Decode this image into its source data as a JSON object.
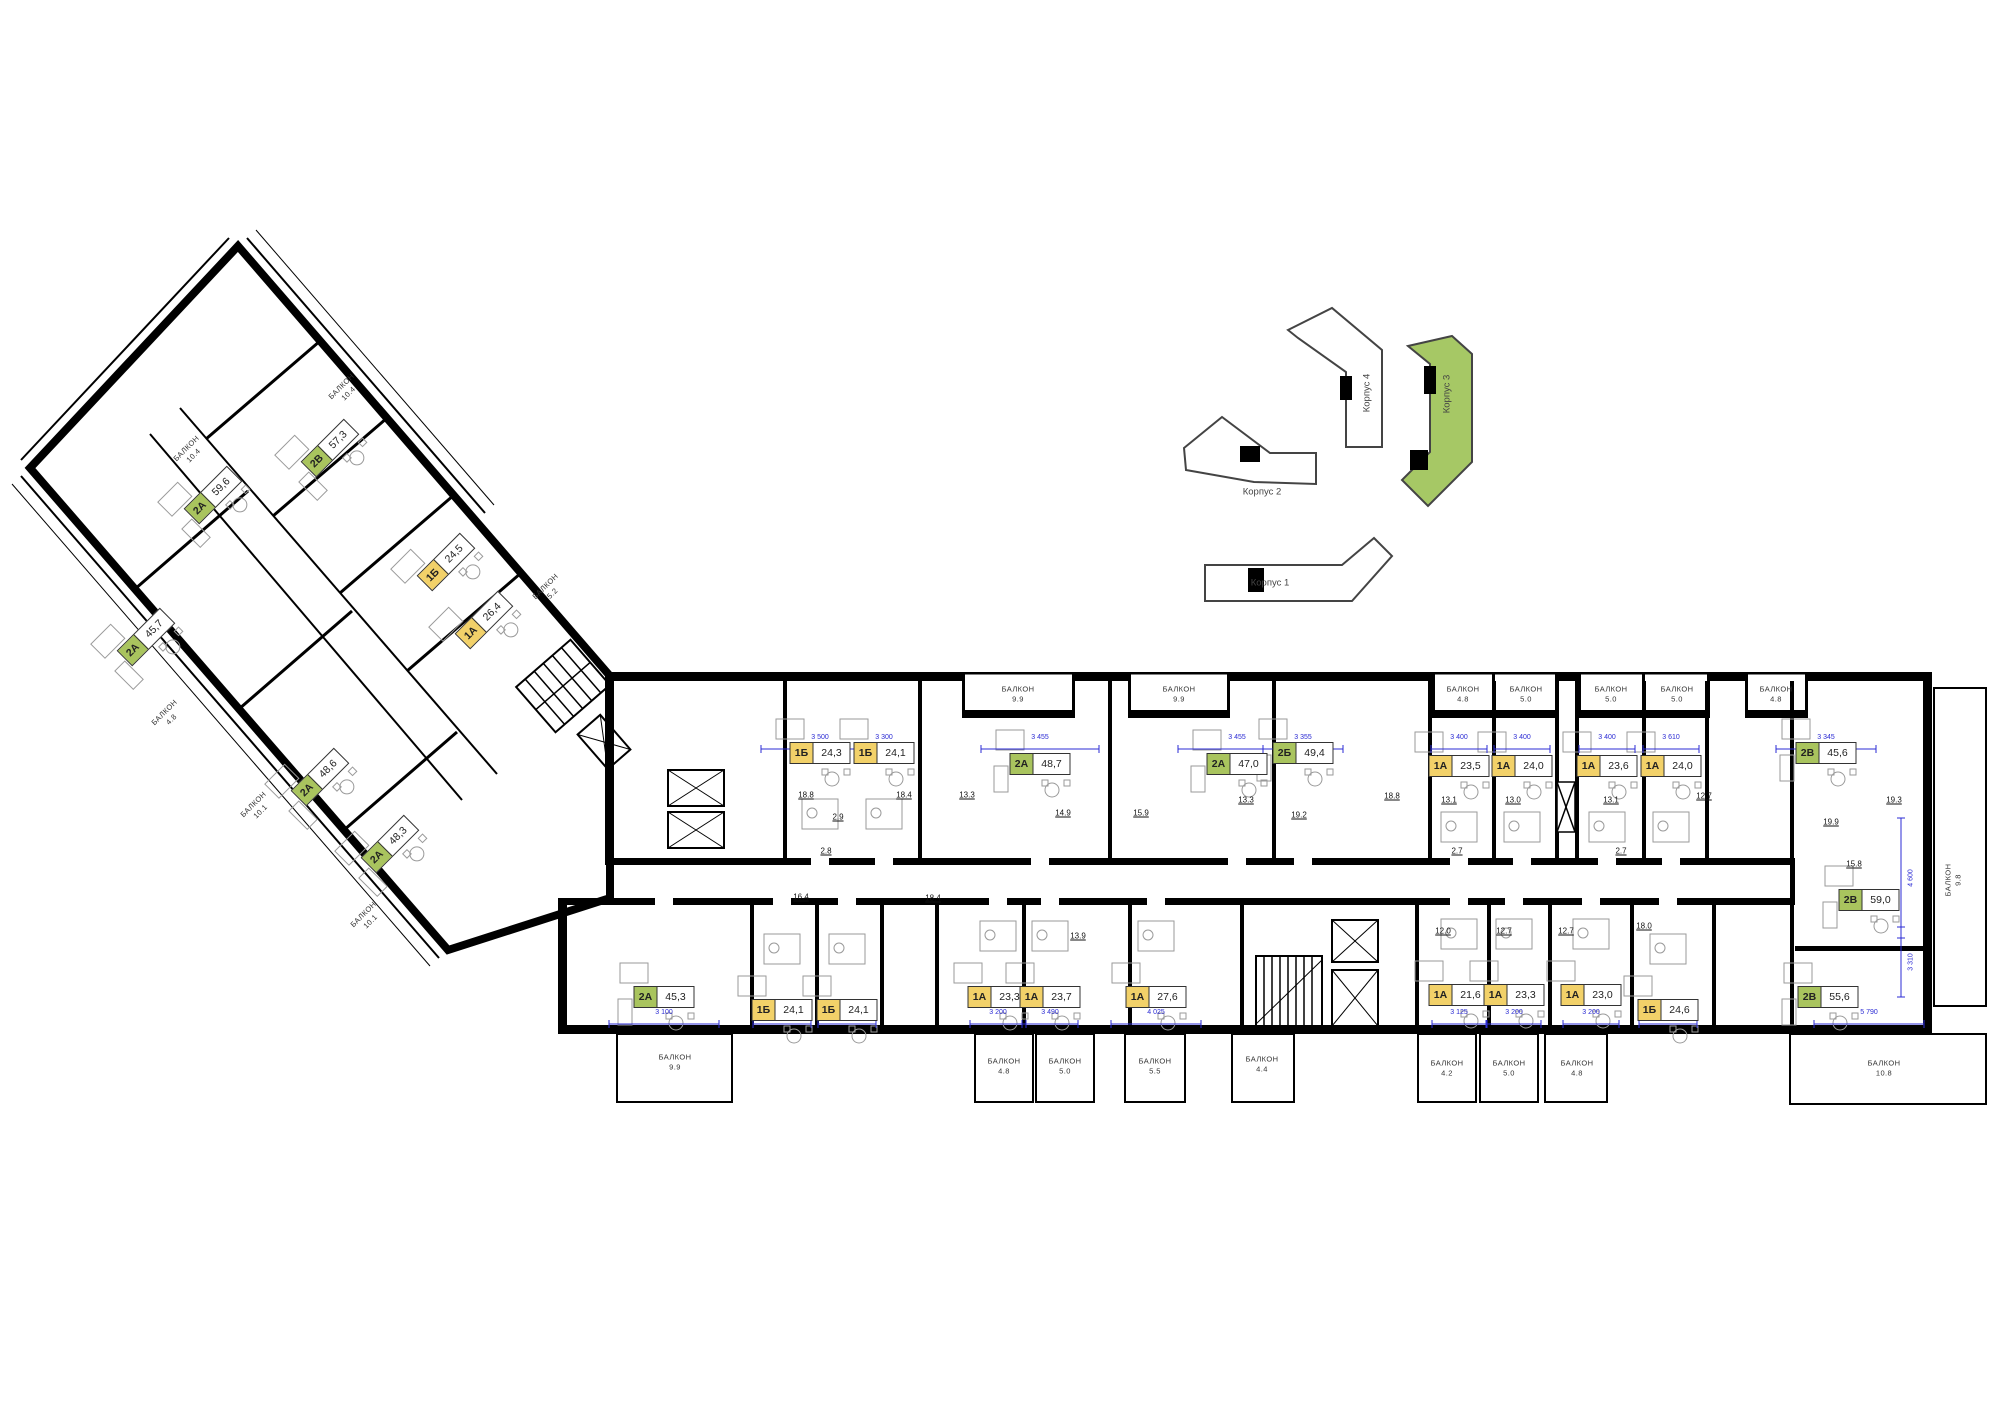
{
  "page_background": "#ffffff",
  "balcony_word": "БАЛКОН",
  "palette": {
    "one_room_badge": "#f2d169",
    "two_room_badge": "#a9c45e",
    "minimap_highlight": "#a6c865",
    "wall": "#000000",
    "dimension_blue": "#2b2bd4"
  },
  "minimap": {
    "corpuses": [
      {
        "label": "Корпус 1",
        "highlighted": false
      },
      {
        "label": "Корпус 2",
        "highlighted": false
      },
      {
        "label": "Корпус 3",
        "highlighted": true
      },
      {
        "label": "Корпус 4",
        "highlighted": false
      }
    ]
  },
  "units": [
    {
      "type": "2В",
      "area": "57,3",
      "color": "green",
      "x": 330,
      "y": 448,
      "rot": -45,
      "row": "wing"
    },
    {
      "type": "2А",
      "area": "59,6",
      "color": "green",
      "x": 213,
      "y": 495,
      "rot": -45,
      "row": "wing"
    },
    {
      "type": "1Б",
      "area": "24,5",
      "color": "yellow",
      "x": 446,
      "y": 562,
      "rot": -45,
      "row": "wing"
    },
    {
      "type": "1А",
      "area": "26,4",
      "color": "yellow",
      "x": 484,
      "y": 620,
      "rot": -45,
      "row": "wing"
    },
    {
      "type": "2А",
      "area": "45,7",
      "color": "green",
      "x": 146,
      "y": 637,
      "rot": -45,
      "row": "wing"
    },
    {
      "type": "2А",
      "area": "48,6",
      "color": "green",
      "x": 320,
      "y": 777,
      "rot": -45,
      "row": "wing"
    },
    {
      "type": "2А",
      "area": "48,3",
      "color": "green",
      "x": 390,
      "y": 844,
      "rot": -45,
      "row": "wing"
    },
    {
      "type": "1Б",
      "area": "24,3",
      "color": "yellow",
      "x": 820,
      "y": 753,
      "rot": 0,
      "row": "top"
    },
    {
      "type": "1Б",
      "area": "24,1",
      "color": "yellow",
      "x": 884,
      "y": 753,
      "rot": 0,
      "row": "top"
    },
    {
      "type": "2А",
      "area": "48,7",
      "color": "green",
      "x": 1040,
      "y": 764,
      "rot": 0,
      "row": "top"
    },
    {
      "type": "2А",
      "area": "47,0",
      "color": "green",
      "x": 1237,
      "y": 764,
      "rot": 0,
      "row": "top"
    },
    {
      "type": "2Б",
      "area": "49,4",
      "color": "green",
      "x": 1303,
      "y": 753,
      "rot": 0,
      "row": "top"
    },
    {
      "type": "1А",
      "area": "23,5",
      "color": "yellow",
      "x": 1459,
      "y": 766,
      "rot": 0,
      "row": "top"
    },
    {
      "type": "1А",
      "area": "24,0",
      "color": "yellow",
      "x": 1522,
      "y": 766,
      "rot": 0,
      "row": "top"
    },
    {
      "type": "1А",
      "area": "23,6",
      "color": "yellow",
      "x": 1607,
      "y": 766,
      "rot": 0,
      "row": "top"
    },
    {
      "type": "1А",
      "area": "24,0",
      "color": "yellow",
      "x": 1671,
      "y": 766,
      "rot": 0,
      "row": "top"
    },
    {
      "type": "2В",
      "area": "45,6",
      "color": "green",
      "x": 1826,
      "y": 753,
      "rot": 0,
      "row": "top"
    },
    {
      "type": "2А",
      "area": "45,3",
      "color": "green",
      "x": 664,
      "y": 997,
      "rot": 0,
      "row": "bottom"
    },
    {
      "type": "1Б",
      "area": "24,1",
      "color": "yellow",
      "x": 782,
      "y": 1010,
      "rot": 0,
      "row": "bottom"
    },
    {
      "type": "1Б",
      "area": "24,1",
      "color": "yellow",
      "x": 847,
      "y": 1010,
      "rot": 0,
      "row": "bottom"
    },
    {
      "type": "1А",
      "area": "23,3",
      "color": "yellow",
      "x": 998,
      "y": 997,
      "rot": 0,
      "row": "bottom"
    },
    {
      "type": "1А",
      "area": "23,7",
      "color": "yellow",
      "x": 1050,
      "y": 997,
      "rot": 0,
      "row": "bottom"
    },
    {
      "type": "1А",
      "area": "27,6",
      "color": "yellow",
      "x": 1156,
      "y": 997,
      "rot": 0,
      "row": "bottom"
    },
    {
      "type": "1А",
      "area": "21,6",
      "color": "yellow",
      "x": 1459,
      "y": 995,
      "rot": 0,
      "row": "bottom"
    },
    {
      "type": "1А",
      "area": "23,3",
      "color": "yellow",
      "x": 1514,
      "y": 995,
      "rot": 0,
      "row": "bottom"
    },
    {
      "type": "1А",
      "area": "23,0",
      "color": "yellow",
      "x": 1591,
      "y": 995,
      "rot": 0,
      "row": "bottom"
    },
    {
      "type": "1Б",
      "area": "24,6",
      "color": "yellow",
      "x": 1668,
      "y": 1010,
      "rot": 0,
      "row": "bottom"
    },
    {
      "type": "2В",
      "area": "59,0",
      "color": "green",
      "x": 1869,
      "y": 900,
      "rot": 0,
      "row": "right"
    },
    {
      "type": "2В",
      "area": "55,6",
      "color": "green",
      "x": 1828,
      "y": 997,
      "rot": 0,
      "row": "right"
    }
  ],
  "balconies": [
    {
      "area": "10.4",
      "x": 345,
      "y": 390,
      "rot": -45
    },
    {
      "area": "10.4",
      "x": 190,
      "y": 452,
      "rot": -45
    },
    {
      "area": "5.2",
      "x": 549,
      "y": 590,
      "rot": -45
    },
    {
      "area": "4.8",
      "x": 168,
      "y": 716,
      "rot": -45
    },
    {
      "area": "10.1",
      "x": 257,
      "y": 808,
      "rot": -45
    },
    {
      "area": "10.1",
      "x": 367,
      "y": 918,
      "rot": -45
    },
    {
      "area": "9.9",
      "x": 1018,
      "y": 694,
      "rot": 0
    },
    {
      "area": "9.9",
      "x": 1179,
      "y": 694,
      "rot": 0
    },
    {
      "area": "4.8",
      "x": 1463,
      "y": 694,
      "rot": 0
    },
    {
      "area": "5.0",
      "x": 1526,
      "y": 694,
      "rot": 0
    },
    {
      "area": "5.0",
      "x": 1611,
      "y": 694,
      "rot": 0
    },
    {
      "area": "5.0",
      "x": 1677,
      "y": 694,
      "rot": 0
    },
    {
      "area": "4.8",
      "x": 1776,
      "y": 694,
      "rot": 0
    },
    {
      "area": "9.9",
      "x": 675,
      "y": 1062,
      "rot": 0
    },
    {
      "area": "4.8",
      "x": 1004,
      "y": 1066,
      "rot": 0
    },
    {
      "area": "5.0",
      "x": 1065,
      "y": 1066,
      "rot": 0
    },
    {
      "area": "5.5",
      "x": 1155,
      "y": 1066,
      "rot": 0
    },
    {
      "area": "4.4",
      "x": 1262,
      "y": 1064,
      "rot": 0
    },
    {
      "area": "4.2",
      "x": 1447,
      "y": 1068,
      "rot": 0
    },
    {
      "area": "5.0",
      "x": 1509,
      "y": 1068,
      "rot": 0
    },
    {
      "area": "4.8",
      "x": 1577,
      "y": 1068,
      "rot": 0
    },
    {
      "area": "10.8",
      "x": 1884,
      "y": 1068,
      "rot": 0
    },
    {
      "area": "9.8",
      "x": 1953,
      "y": 880,
      "rot": 90
    }
  ],
  "room_areas": [
    {
      "v": "18.8",
      "x": 806,
      "y": 795
    },
    {
      "v": "2.9",
      "x": 838,
      "y": 817
    },
    {
      "v": "2.8",
      "x": 826,
      "y": 851
    },
    {
      "v": "18.4",
      "x": 904,
      "y": 795
    },
    {
      "v": "13.3",
      "x": 967,
      "y": 795
    },
    {
      "v": "14.9",
      "x": 1063,
      "y": 813
    },
    {
      "v": "15.9",
      "x": 1141,
      "y": 813
    },
    {
      "v": "13.3",
      "x": 1246,
      "y": 800
    },
    {
      "v": "19.2",
      "x": 1299,
      "y": 815
    },
    {
      "v": "18.8",
      "x": 1392,
      "y": 796
    },
    {
      "v": "13.1",
      "x": 1449,
      "y": 800
    },
    {
      "v": "2.7",
      "x": 1457,
      "y": 851
    },
    {
      "v": "13.0",
      "x": 1513,
      "y": 800
    },
    {
      "v": "13.1",
      "x": 1611,
      "y": 800
    },
    {
      "v": "2.7",
      "x": 1621,
      "y": 851
    },
    {
      "v": "12.7",
      "x": 1704,
      "y": 796
    },
    {
      "v": "19.9",
      "x": 1831,
      "y": 822
    },
    {
      "v": "15.8",
      "x": 1854,
      "y": 864
    },
    {
      "v": "16.4",
      "x": 801,
      "y": 897
    },
    {
      "v": "18.4",
      "x": 933,
      "y": 898
    },
    {
      "v": "13.9",
      "x": 1078,
      "y": 936
    },
    {
      "v": "12.0",
      "x": 1443,
      "y": 931
    },
    {
      "v": "12.7",
      "x": 1504,
      "y": 931
    },
    {
      "v": "12.7",
      "x": 1566,
      "y": 931
    },
    {
      "v": "18.0",
      "x": 1644,
      "y": 926
    },
    {
      "v": "19.3",
      "x": 1894,
      "y": 800
    }
  ],
  "dimensions": [
    {
      "v": "3 500",
      "x": 820,
      "y": 741,
      "w": 118,
      "rot": 0
    },
    {
      "v": "3 300",
      "x": 884,
      "y": 741,
      "w": 58,
      "rot": 0
    },
    {
      "v": "3 455",
      "x": 1040,
      "y": 741,
      "w": 118,
      "rot": 0
    },
    {
      "v": "3 455",
      "x": 1237,
      "y": 741,
      "w": 118,
      "rot": 0
    },
    {
      "v": "3 355",
      "x": 1303,
      "y": 741,
      "w": 80,
      "rot": 0
    },
    {
      "v": "3 400",
      "x": 1459,
      "y": 741,
      "w": 56,
      "rot": 0
    },
    {
      "v": "3 400",
      "x": 1522,
      "y": 741,
      "w": 56,
      "rot": 0
    },
    {
      "v": "3 400",
      "x": 1607,
      "y": 741,
      "w": 56,
      "rot": 0
    },
    {
      "v": "3 610",
      "x": 1671,
      "y": 741,
      "w": 56,
      "rot": 0
    },
    {
      "v": "3 345",
      "x": 1826,
      "y": 741,
      "w": 100,
      "rot": 0
    },
    {
      "v": "3 100",
      "x": 664,
      "y": 1016,
      "w": 110,
      "rot": 0
    },
    {
      "v": "3 300",
      "x": 782,
      "y": 1016,
      "w": 58,
      "rot": 0
    },
    {
      "v": "3 300",
      "x": 847,
      "y": 1016,
      "w": 58,
      "rot": 0
    },
    {
      "v": "3 200",
      "x": 998,
      "y": 1016,
      "w": 56,
      "rot": 0
    },
    {
      "v": "3 490",
      "x": 1050,
      "y": 1016,
      "w": 56,
      "rot": 0
    },
    {
      "v": "4 025",
      "x": 1156,
      "y": 1016,
      "w": 90,
      "rot": 0
    },
    {
      "v": "3 125",
      "x": 1459,
      "y": 1016,
      "w": 54,
      "rot": 0
    },
    {
      "v": "3 200",
      "x": 1514,
      "y": 1016,
      "w": 54,
      "rot": 0
    },
    {
      "v": "3 200",
      "x": 1591,
      "y": 1016,
      "w": 56,
      "rot": 0
    },
    {
      "v": "3 300",
      "x": 1668,
      "y": 1016,
      "w": 58,
      "rot": 0
    },
    {
      "v": "5 790",
      "x": 1869,
      "y": 1016,
      "w": 110,
      "rot": 0
    },
    {
      "v": "4 600",
      "x": 1911,
      "y": 878,
      "w": 120,
      "rot": 90
    },
    {
      "v": "3 310",
      "x": 1911,
      "y": 962,
      "w": 70,
      "rot": 90
    }
  ]
}
